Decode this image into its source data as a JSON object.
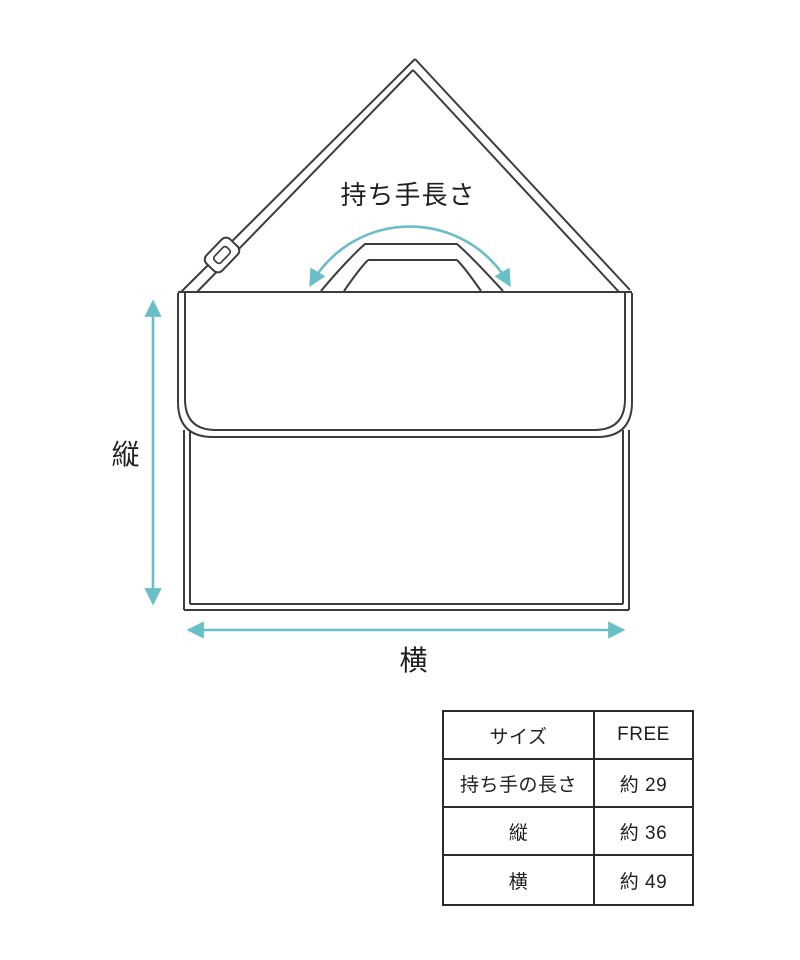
{
  "diagram": {
    "handle_length_label": "持ち手長さ",
    "height_label": "縦",
    "width_label": "横"
  },
  "size_table": {
    "rows": [
      {
        "label": "サイズ",
        "value": "FREE"
      },
      {
        "label": "持ち手の長さ",
        "value": "約 29"
      },
      {
        "label": "縦",
        "value": "約 36"
      },
      {
        "label": "横",
        "value": "約 49"
      }
    ]
  },
  "colors": {
    "line": "#3c3c3c",
    "accent": "#6abfc6",
    "table_border": "#2b2b2b"
  }
}
